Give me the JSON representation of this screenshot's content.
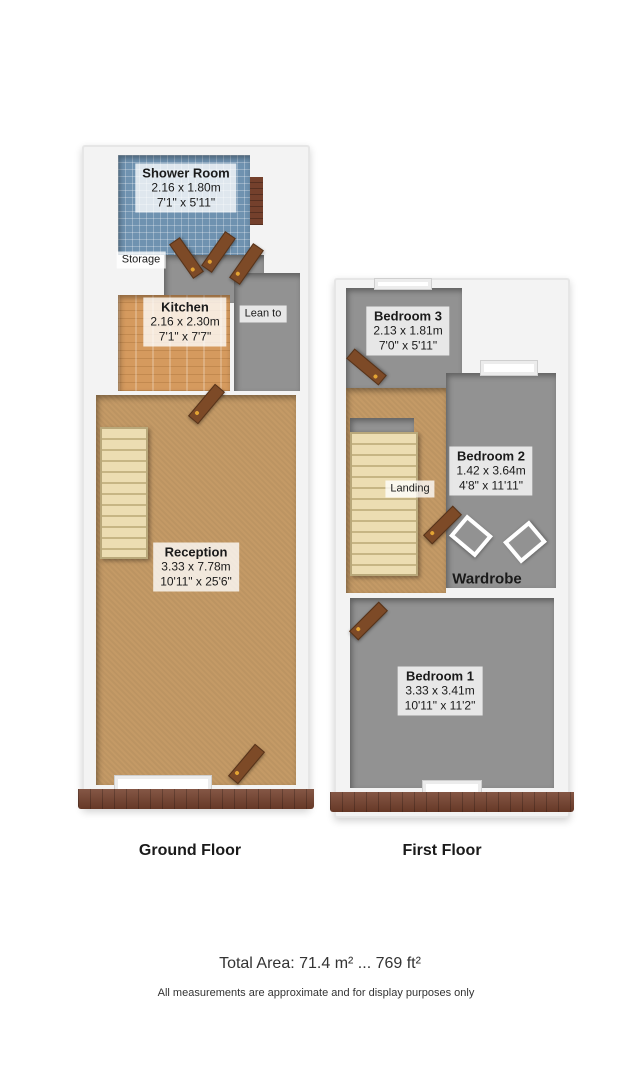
{
  "floors": {
    "ground": {
      "caption": "Ground Floor",
      "rooms": {
        "shower": {
          "name": "Shower Room",
          "metric": "2.16 x 1.80m",
          "imperial": "7'1\" x 5'11\""
        },
        "storage": {
          "name": "Storage"
        },
        "kitchen": {
          "name": "Kitchen",
          "metric": "2.16 x 2.30m",
          "imperial": "7'1\" x 7'7\""
        },
        "leanto": {
          "name": "Lean to"
        },
        "reception": {
          "name": "Reception",
          "metric": "3.33 x 7.78m",
          "imperial": "10'11\" x 25'6\""
        }
      }
    },
    "first": {
      "caption": "First Floor",
      "rooms": {
        "bedroom3": {
          "name": "Bedroom 3",
          "metric": "2.13 x 1.81m",
          "imperial": "7'0\" x 5'11\""
        },
        "landing": {
          "name": "Landing"
        },
        "bedroom2": {
          "name": "Bedroom 2",
          "metric": "1.42 x 3.64m",
          "imperial": "4'8\" x 11'11\""
        },
        "wardrobe": {
          "name": "Wardrobe"
        },
        "bedroom1": {
          "name": "Bedroom 1",
          "metric": "3.33 x 3.41m",
          "imperial": "10'11\" x 11'2\""
        }
      }
    }
  },
  "footer": {
    "total_area": "Total Area: 71.4 m² ... 769 ft²",
    "disclaimer": "All measurements are approximate and for display purposes only"
  },
  "colors": {
    "wall": "#f3f3f3",
    "tile_floor": "#6f92b0",
    "wood_floor": "#d59a5e",
    "carpet_floor": "#c49a66",
    "gray_floor": "#929292",
    "stairs": "#ecddb2",
    "brick": "#74402c",
    "door": "#7d4a27",
    "background": "#ffffff"
  }
}
